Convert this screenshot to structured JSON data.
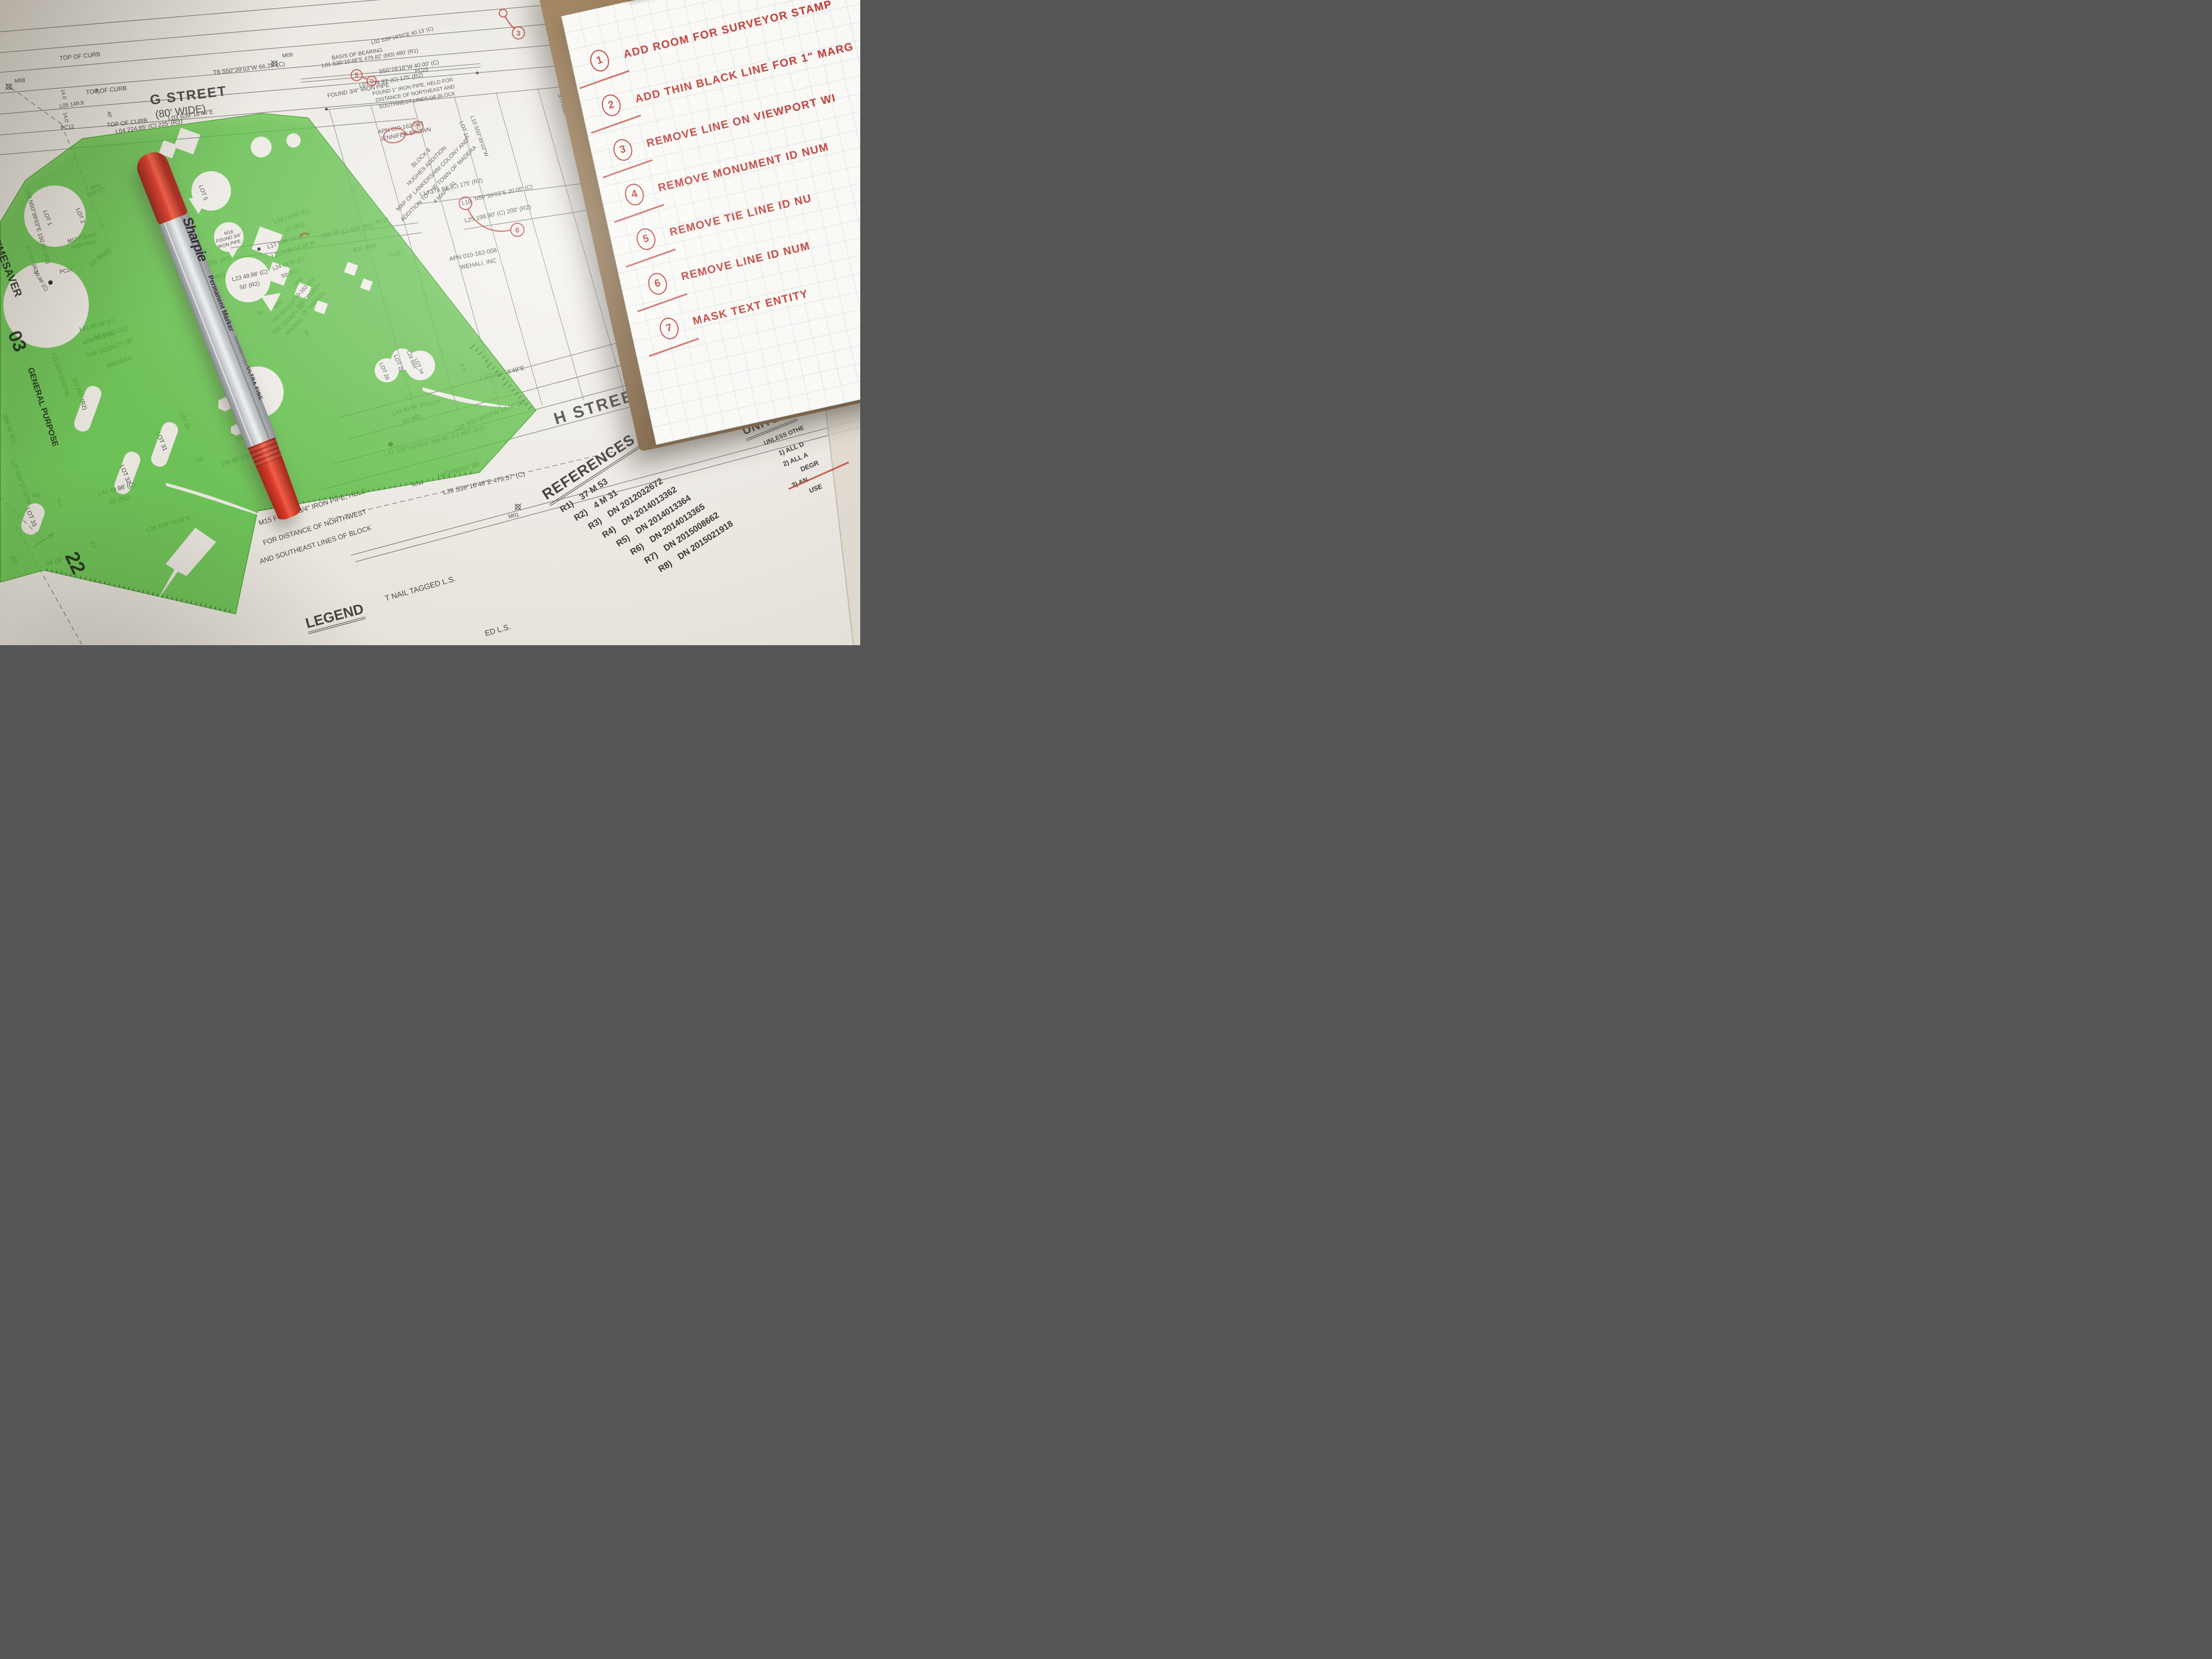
{
  "clipboard": {
    "notes": [
      {
        "num": "1",
        "text": "ADD ROOM FOR SURVEYOR STAMP"
      },
      {
        "num": "2",
        "text": "ADD THIN BLACK LINE FOR 1\" MARG"
      },
      {
        "num": "3",
        "text": "REMOVE LINE ON VIEWPORT WI"
      },
      {
        "num": "4",
        "text": "REMOVE MONUMENT ID NUM"
      },
      {
        "num": "5",
        "text": "REMOVE TIE LINE ID NU"
      },
      {
        "num": "6",
        "text": "REMOVE LINE ID NUM"
      },
      {
        "num": "7",
        "text": "MASK TEXT ENTITY"
      }
    ]
  },
  "pen": {
    "brand": "Sharpie",
    "type": "Permanent Marker",
    "tip": "ULTRA FINE",
    "origin_note": "Assembled in USA"
  },
  "references": {
    "title": "REFERENCES",
    "items": [
      {
        "label": "R1)",
        "value": "37 M 53"
      },
      {
        "label": "R2)",
        "value": "4 M 31"
      },
      {
        "label": "R3)",
        "value": "DN 2012032672"
      },
      {
        "label": "R4)",
        "value": "DN 2014013362"
      },
      {
        "label": "R5)",
        "value": "DN 2014013364"
      },
      {
        "label": "R6)",
        "value": "DN 2014013365"
      },
      {
        "label": "R7)",
        "value": "DN 2015008662"
      },
      {
        "label": "R8)",
        "value": "DN 2015021918"
      }
    ]
  },
  "units": {
    "title": "UNITS",
    "subtitle": "UNLESS OTHE",
    "item1": "1)   ALL D",
    "item2": "2)   ALL A",
    "item2b": "DEGR",
    "item3": "3)   AN",
    "item3b": "USE"
  },
  "template_tool": {
    "brand": "TIMESAVER",
    "series": "GENERAL PURPOSE",
    "mark_a": "03",
    "mark_b": "22",
    "color": "#4fbe35"
  },
  "map_labels": [
    {
      "t": "TOP OF CURB",
      "x": 108,
      "y": 102,
      "r": -6,
      "s": 11
    },
    {
      "t": "TOP OF CURB",
      "x": 156,
      "y": 164,
      "r": -6,
      "s": 11
    },
    {
      "t": "G STREET",
      "x": 272,
      "y": 170,
      "r": -7,
      "s": 25,
      "b": 1,
      "ls": 2
    },
    {
      "t": "(80' WIDE)",
      "x": 282,
      "y": 200,
      "r": -7,
      "s": 19
    },
    {
      "t": "TOP OF CURB",
      "x": 194,
      "y": 224,
      "r": -7,
      "s": 11
    },
    {
      "t": "L04 224.85' (C) 225' (R2)",
      "x": 210,
      "y": 236,
      "r": -9,
      "s": 11
    },
    {
      "t": "L03 S39°16'48\"E",
      "x": 306,
      "y": 212,
      "r": -9,
      "s": 11
    },
    {
      "t": "T8 S50°39'03\"W   66.25' (C)",
      "x": 388,
      "y": 128,
      "r": -7,
      "s": 11
    },
    {
      "t": "M09",
      "x": 514,
      "y": 98,
      "r": -7,
      "s": 10
    },
    {
      "t": "M08",
      "x": 26,
      "y": 144,
      "r": -5,
      "s": 10
    },
    {
      "t": "14.0'",
      "x": 118,
      "y": 162,
      "r": 78,
      "s": 9
    },
    {
      "t": "40'",
      "x": 180,
      "y": 160,
      "r": 75,
      "s": 9
    },
    {
      "t": "14.0'",
      "x": 122,
      "y": 204,
      "r": 78,
      "s": 9
    },
    {
      "t": "40'",
      "x": 202,
      "y": 202,
      "r": 75,
      "s": 9
    },
    {
      "t": "L05 149.9",
      "x": 108,
      "y": 190,
      "r": -9,
      "s": 10
    },
    {
      "t": "PC12",
      "x": 110,
      "y": 230,
      "r": -8,
      "s": 10
    },
    {
      "t": "BASIS OF BEARING",
      "x": 604,
      "y": 102,
      "r": -9,
      "s": 10
    },
    {
      "t": "L01 S39°16'48\"E   479.82' (M3) 480' (R1)",
      "x": 586,
      "y": 116,
      "r": -9,
      "s": 10
    },
    {
      "t": "L02 S39°18'50\"E  40.13' (C)",
      "x": 676,
      "y": 74,
      "r": -13,
      "s": 9.5
    },
    {
      "t": "S50°28'18\"W   40.00' (C)",
      "x": 690,
      "y": 126,
      "r": -9,
      "s": 10.5
    },
    {
      "t": "PC23",
      "x": 756,
      "y": 126,
      "r": -9,
      "s": 9.5
    },
    {
      "t": "FOUND 3/4\" IRON PIPE",
      "x": 596,
      "y": 170,
      "r": -10,
      "s": 10.5
    },
    {
      "t": "L07 174.93' (C) 175' (R2)",
      "x": 654,
      "y": 152,
      "r": -10,
      "s": 10.5
    },
    {
      "t": "FOUND 1\" IRON PIPE, HELD FOR",
      "x": 678,
      "y": 167,
      "r": -10,
      "s": 9.5
    },
    {
      "t": "DISTANCE OF NORTHEAST AND",
      "x": 684,
      "y": 179,
      "r": -10,
      "s": 9.5
    },
    {
      "t": "SOUTHWEST LINES OF BLOCK",
      "x": 690,
      "y": 191,
      "r": -10,
      "s": 9.5
    },
    {
      "t": "APN 010-162-003",
      "x": 688,
      "y": 236,
      "r": -11,
      "s": 10.5
    },
    {
      "t": "JENNIFER BROWN",
      "x": 692,
      "y": 249,
      "r": -11,
      "s": 10.5
    },
    {
      "t": "BLOCK 8",
      "x": 768,
      "y": 288,
      "r": -45,
      "s": 10.5,
      "ctr": 1
    },
    {
      "t": "HUGHES ADDITION",
      "x": 778,
      "y": 303,
      "r": -45,
      "s": 10.5,
      "ctr": 1
    },
    {
      "t": "MAP OF LANKERSHIM COLONY AND",
      "x": 789,
      "y": 319,
      "r": -45,
      "s": 10.5,
      "ctr": 1
    },
    {
      "t": "ADDITION TO THE TOWN OF MADERA",
      "x": 800,
      "y": 335,
      "r": -45,
      "s": 10.5,
      "ctr": 1
    },
    {
      "t": "4 MAPS 31",
      "x": 811,
      "y": 351,
      "r": -45,
      "s": 10.5,
      "ctr": 1
    },
    {
      "t": "L14 174.93' (C) 175' (R2)",
      "x": 764,
      "y": 350,
      "r": -13,
      "s": 10.5
    },
    {
      "t": "L18",
      "x": 841,
      "y": 366,
      "r": -12,
      "s": 10.5
    },
    {
      "t": "N50°39'03\"E   20.00' (C)",
      "x": 864,
      "y": 358,
      "r": -12,
      "s": 10.5
    },
    {
      "t": "PC22",
      "x": 1064,
      "y": 318,
      "r": -12,
      "s": 9.5
    },
    {
      "t": "PC21",
      "x": 1078,
      "y": 352,
      "r": -12,
      "s": 9.5
    },
    {
      "t": "PC17",
      "x": 684,
      "y": 402,
      "r": -12,
      "s": 9.5
    },
    {
      "t": "PC18",
      "x": 706,
      "y": 462,
      "r": -12,
      "s": 9.5
    },
    {
      "t": "L25 199.90' (C) 200' (R2)",
      "x": 846,
      "y": 398,
      "r": -12,
      "s": 11
    },
    {
      "t": "APN 010-162-008",
      "x": 818,
      "y": 468,
      "r": -11,
      "s": 11
    },
    {
      "t": "WEHALI, INC",
      "x": 838,
      "y": 483,
      "r": -11,
      "s": 11
    },
    {
      "t": "LOT 16",
      "x": 844,
      "y": 220,
      "r": 70,
      "s": 10
    },
    {
      "t": "L10 S50°39'03\"W",
      "x": 864,
      "y": 210,
      "r": 70,
      "s": 10
    },
    {
      "t": "STREET",
      "x": 1026,
      "y": 168,
      "r": 72,
      "s": 12
    },
    {
      "t": "M16",
      "x": 417,
      "y": 424,
      "r": -15,
      "s": 8.5,
      "ctr": 1
    },
    {
      "t": "FOUND 3/4\"",
      "x": 417,
      "y": 434,
      "r": -15,
      "s": 8.5,
      "ctr": 1
    },
    {
      "t": "IRON PIPE",
      "x": 418,
      "y": 445,
      "r": -15,
      "s": 8.5,
      "ctr": 1
    },
    {
      "t": "L13 74.90' (C)",
      "x": 498,
      "y": 400,
      "r": -18,
      "s": 10.5
    },
    {
      "t": "75' (R2)",
      "x": 518,
      "y": 416,
      "r": -18,
      "s": 10.5
    },
    {
      "t": "L17 N39°16'48\"W",
      "x": 486,
      "y": 446,
      "r": -18,
      "s": 10.5
    },
    {
      "t": "399.78' (C) 400' (R2)",
      "x": 584,
      "y": 426,
      "r": -12,
      "s": 10.5
    },
    {
      "t": "L20 N39°16'48\"W",
      "x": 494,
      "y": 463,
      "r": -18,
      "s": 10.5
    },
    {
      "t": "400' (R2)",
      "x": 642,
      "y": 452,
      "r": -12,
      "s": 10.5
    },
    {
      "t": "L24 49.94' (C)",
      "x": 496,
      "y": 486,
      "r": -18,
      "s": 9.5
    },
    {
      "t": "50' (R2)",
      "x": 512,
      "y": 500,
      "r": -18,
      "s": 9.5
    },
    {
      "t": "L23 49.98' (C)",
      "x": 422,
      "y": 505,
      "r": -13,
      "s": 10.5
    },
    {
      "t": "50' (R2)",
      "x": 436,
      "y": 520,
      "r": -13,
      "s": 10.5
    },
    {
      "t": "250' (R2)",
      "x": 378,
      "y": 476,
      "r": -14,
      "s": 10.5
    },
    {
      "t": "200' (R2)",
      "x": 368,
      "y": 506,
      "r": -14,
      "s": 10.5
    },
    {
      "t": "APN",
      "x": 545,
      "y": 515,
      "r": -45,
      "s": 9.5,
      "ctr": 1
    },
    {
      "t": "010-162-009",
      "x": 554,
      "y": 528,
      "r": -45,
      "s": 9.5,
      "ctr": 1
    },
    {
      "t": "THE COUNTY",
      "x": 563,
      "y": 541,
      "r": -45,
      "s": 9.5,
      "ctr": 1
    },
    {
      "t": "OF MADERA",
      "x": 572,
      "y": 554,
      "r": -45,
      "s": 9.5,
      "ctr": 1
    },
    {
      "t": "APN",
      "x": 508,
      "y": 556,
      "r": -43,
      "s": 9.5,
      "ctr": 1
    },
    {
      "t": "010-162-010",
      "x": 517,
      "y": 569,
      "r": -43,
      "s": 9.5,
      "ctr": 1
    },
    {
      "t": "THE COUNTY OF",
      "x": 527,
      "y": 583,
      "r": -43,
      "s": 9.5,
      "ctr": 1
    },
    {
      "t": "MADERA",
      "x": 537,
      "y": 596,
      "r": -43,
      "s": 9.5,
      "ctr": 1
    },
    {
      "t": "M13 FOUND",
      "x": 122,
      "y": 436,
      "r": -14,
      "s": 9.5
    },
    {
      "t": "IRON PIPE",
      "x": 128,
      "y": 448,
      "r": -14,
      "s": 9.5
    },
    {
      "t": "ALLEY",
      "x": 174,
      "y": 466,
      "r": -35,
      "s": 9.5
    },
    {
      "t": "(20' WIDE)",
      "x": 162,
      "y": 480,
      "r": -35,
      "s": 9.5
    },
    {
      "t": "PC14",
      "x": 108,
      "y": 492,
      "r": -12,
      "s": 9.5
    },
    {
      "t": "L21 49.98' (C)",
      "x": 144,
      "y": 596,
      "r": -14,
      "s": 10.5
    },
    {
      "t": "50' (R2)",
      "x": 170,
      "y": 611,
      "r": -14,
      "s": 10.5
    },
    {
      "t": "APN 010-162-012",
      "x": 148,
      "y": 622,
      "r": -19,
      "s": 11
    },
    {
      "t": "THE COUNTY OF",
      "x": 156,
      "y": 645,
      "r": -19,
      "s": 11
    },
    {
      "t": "MADERA",
      "x": 194,
      "y": 663,
      "r": -19,
      "s": 11
    },
    {
      "t": "L11 S50°39'03\"W",
      "x": 102,
      "y": 642,
      "r": 72,
      "s": 10.5
    },
    {
      "t": "(C) 150' (R2)",
      "x": 141,
      "y": 688,
      "r": 72,
      "s": 10.5
    },
    {
      "t": "L08 N50°39'03\"E  150.00' (R2)",
      "x": 54,
      "y": 344,
      "r": 74,
      "s": 10.5
    },
    {
      "t": "LOT 1",
      "x": 86,
      "y": 382,
      "r": 70,
      "s": 10.5
    },
    {
      "t": "LOT 2",
      "x": 146,
      "y": 378,
      "r": 70,
      "s": 10.5
    },
    {
      "t": "APN",
      "x": 164,
      "y": 340,
      "r": -18,
      "s": 9.5
    },
    {
      "t": "THE CO",
      "x": 156,
      "y": 352,
      "r": -18,
      "s": 9.5
    },
    {
      "t": "(C) 320' (R2)",
      "x": 54,
      "y": 446,
      "r": 72,
      "s": 9.5
    },
    {
      "t": "19.98' (C)",
      "x": 68,
      "y": 492,
      "r": 60,
      "s": 9.5
    },
    {
      "t": "LOT 5",
      "x": 370,
      "y": 336,
      "r": 70,
      "s": 10.5
    },
    {
      "t": "3/8",
      "x": 468,
      "y": 568,
      "r": -18,
      "s": 8
    },
    {
      "t": "3/8",
      "x": 560,
      "y": 600,
      "r": 70,
      "s": 8
    },
    {
      "t": "LOT 27",
      "x": 450,
      "y": 694,
      "r": 68,
      "s": 10.5
    },
    {
      "t": "LOT 28",
      "x": 424,
      "y": 708,
      "r": 68,
      "s": 10.5
    },
    {
      "t": "LOT 30",
      "x": 334,
      "y": 748,
      "r": 68,
      "s": 10.5
    },
    {
      "t": "LOT 31",
      "x": 292,
      "y": 786,
      "r": 68,
      "s": 11
    },
    {
      "t": "LOT 32",
      "x": 226,
      "y": 846,
      "r": 68,
      "s": 11
    },
    {
      "t": "LOT 33",
      "x": 54,
      "y": 924,
      "r": 68,
      "s": 11
    },
    {
      "t": "LOT 26",
      "x": 698,
      "y": 660,
      "r": 68,
      "s": 10
    },
    {
      "t": "LOT 25",
      "x": 724,
      "y": 646,
      "r": 68,
      "s": 10
    },
    {
      "t": "L29 S50°",
      "x": 748,
      "y": 638,
      "r": 68,
      "s": 9
    },
    {
      "t": "LOT 24",
      "x": 762,
      "y": 652,
      "r": 68,
      "s": 9
    },
    {
      "t": "L33 49.98' (C)",
      "x": 430,
      "y": 796,
      "r": -15,
      "s": 10.5
    },
    {
      "t": "50' (R2)",
      "x": 446,
      "y": 811,
      "r": -15,
      "s": 10.5
    },
    {
      "t": "L32",
      "x": 354,
      "y": 836,
      "r": -15,
      "s": 9.5
    },
    {
      "t": "199.89' (C) 200' (R2)",
      "x": 402,
      "y": 842,
      "r": -17,
      "s": 10.5
    },
    {
      "t": "M15 FOUND 3/4\" IRON PIPE, HELD",
      "x": 470,
      "y": 948,
      "r": -17,
      "s": 12.5
    },
    {
      "t": "FOR DISTANCE OF NORTHWEST",
      "x": 478,
      "y": 984,
      "r": -17,
      "s": 12.5
    },
    {
      "t": "AND SOUTHEAST LINES OF BLOCK",
      "x": 472,
      "y": 1018,
      "r": -17,
      "s": 12.5
    },
    {
      "t": "8.0'",
      "x": 846,
      "y": 662,
      "r": 74,
      "s": 10
    },
    {
      "t": "L36 S39°16'48\"E",
      "x": 874,
      "y": 686,
      "r": -14,
      "s": 11
    },
    {
      "t": "199.90' (C) 200' (R2)",
      "x": 1136,
      "y": 648,
      "r": -16,
      "s": 11
    },
    {
      "t": "HELD PARALLEL TO",
      "x": 1264,
      "y": 640,
      "r": -20,
      "s": 10.5
    },
    {
      "t": "NORTHEAST SIDE",
      "x": 1276,
      "y": 656,
      "r": -20,
      "s": 10.5
    },
    {
      "t": "OF BLOCK",
      "x": 1302,
      "y": 672,
      "r": -20,
      "s": 10.5
    },
    {
      "t": "T09 S50°38'44\"W  4",
      "x": 1268,
      "y": 690,
      "r": -20,
      "s": 10.5
    },
    {
      "t": "CAL TRANS MON - N",
      "x": 1270,
      "y": 712,
      "r": -20,
      "s": 10.5
    },
    {
      "t": "L34 49.94' (C)",
      "x": 714,
      "y": 750,
      "r": -18,
      "s": 10.5
    },
    {
      "t": "50' (R2)",
      "x": 732,
      "y": 765,
      "r": -18,
      "s": 10.5
    },
    {
      "t": "PC19",
      "x": 778,
      "y": 734,
      "r": -15,
      "s": 9.5
    },
    {
      "t": "L37 S39°16'48\"E   399.60' (C) 400' (R2)",
      "x": 700,
      "y": 824,
      "r": -15,
      "s": 11
    },
    {
      "t": "L38 S50°39'03\"W   44.00' (C)",
      "x": 828,
      "y": 778,
      "r": -22,
      "s": 11
    },
    {
      "t": "H STREET",
      "x": 1006,
      "y": 750,
      "r": -17,
      "s": 30,
      "b": 1,
      "ls": 3
    },
    {
      "t": "HIGHWAY 99",
      "x": 796,
      "y": 862,
      "r": -17,
      "s": 13
    },
    {
      "t": "R/W",
      "x": 750,
      "y": 880,
      "r": -15,
      "s": 11
    },
    {
      "t": "L39 S39°16'48\"E   479.57' (C)",
      "x": 806,
      "y": 892,
      "r": -13,
      "s": 12
    },
    {
      "t": "M01",
      "x": 926,
      "y": 938,
      "r": -12,
      "s": 10
    },
    {
      "t": "T NAIL TAGGED L.S.",
      "x": 700,
      "y": 1084,
      "r": -16,
      "s": 14
    },
    {
      "t": "ED L.S.",
      "x": 882,
      "y": 1148,
      "r": -16,
      "s": 14
    },
    {
      "t": "LEGEND",
      "x": 554,
      "y": 1124,
      "r": -15,
      "s": 26,
      "b": 1,
      "u": 1
    },
    {
      "t": "399.98' (C)",
      "x": 12,
      "y": 754,
      "r": 70,
      "s": 11
    },
    {
      "t": "L27 S50°37'12\"W",
      "x": 28,
      "y": 836,
      "r": 70,
      "s": 11
    },
    {
      "t": "40'",
      "x": 58,
      "y": 898,
      "r": -10,
      "s": 12
    },
    {
      "t": "L31 49.98' (C)",
      "x": 178,
      "y": 896,
      "r": -15,
      "s": 11
    },
    {
      "t": "50' (R2)",
      "x": 198,
      "y": 912,
      "r": -15,
      "s": 11
    },
    {
      "t": "L35 S39°16'48\"E",
      "x": 266,
      "y": 962,
      "r": -16,
      "s": 11
    },
    {
      "t": "14.0'",
      "x": 110,
      "y": 906,
      "r": 72,
      "s": 9
    },
    {
      "t": "8.0'",
      "x": 172,
      "y": 986,
      "r": 72,
      "s": 9
    },
    {
      "t": "44.00' (C)",
      "x": 82,
      "y": 1022,
      "r": -15,
      "s": 12
    },
    {
      "t": "(C)",
      "x": 28,
      "y": 1012,
      "r": 70,
      "s": 11
    },
    {
      "t": "TIMESAVER",
      "x": 0,
      "y": 430,
      "r": 68,
      "s": 20,
      "b": 1,
      "layer": "tpl"
    },
    {
      "t": "03",
      "x": 40,
      "y": 598,
      "r": 68,
      "s": 34,
      "b": 1,
      "layer": "tpl"
    },
    {
      "t": "GENERAL PURPOSE",
      "x": 62,
      "y": 668,
      "r": 72,
      "s": 15,
      "b": 1,
      "layer": "tpl"
    },
    {
      "t": "22",
      "x": 146,
      "y": 1000,
      "r": 65,
      "s": 36,
      "b": 1,
      "layer": "tpl"
    }
  ],
  "annotations": [
    {
      "t": "",
      "x": 917,
      "y": 24,
      "d": 16
    },
    {
      "t": "3",
      "x": 945,
      "y": 60,
      "d": 24
    },
    {
      "t": "5",
      "x": 650,
      "y": 137,
      "d": 22
    },
    {
      "t": "T9",
      "x": 677,
      "y": 147,
      "d": 19,
      "fs": 8
    },
    {
      "t": "7",
      "x": 761,
      "y": 231,
      "d": 22
    },
    {
      "t": "",
      "x": 848,
      "y": 370,
      "d": 25
    },
    {
      "t": "6",
      "x": 943,
      "y": 419,
      "d": 26
    },
    {
      "t": "",
      "x": 719,
      "y": 247,
      "d": 42,
      "ry": 14
    }
  ]
}
